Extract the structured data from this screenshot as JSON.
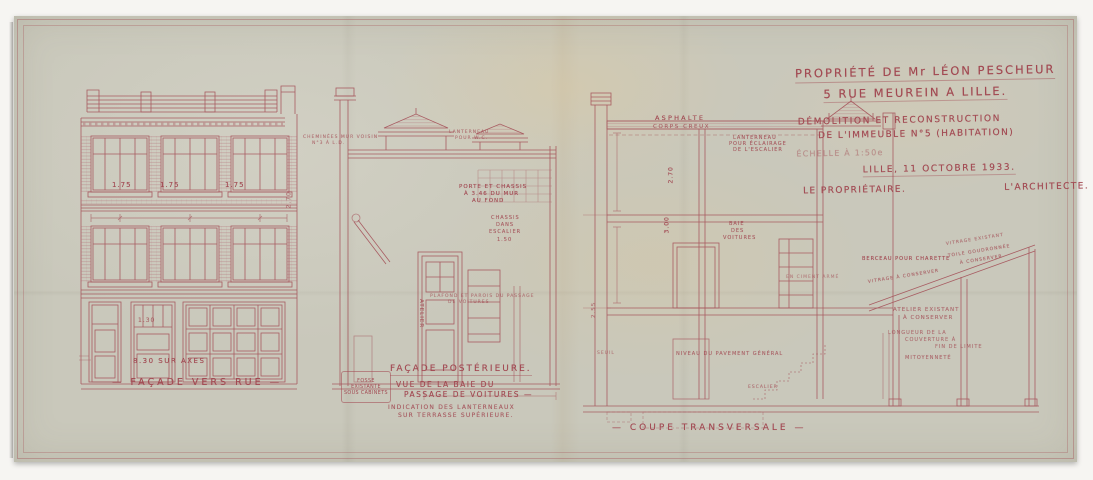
{
  "colors": {
    "ink": "#a24952",
    "hatch": "#b06a72",
    "paper": "#c9c8bb"
  },
  "title_block": {
    "line1": "PROPRIÉTÉ DE Mr LÉON PESCHEUR",
    "line2": "5 RUE MEUREIN A LILLE.",
    "line3": "DÉMOLITION ET RECONSTRUCTION",
    "line4": "DE L'IMMEUBLE N°5 (HABITATION)",
    "scale": "ÉCHELLE À 1:50e",
    "date": "LILLE, 11 OCTOBRE 1933.",
    "owner": "LE PROPRIÉTAIRE.",
    "architect": "L'ARCHITECTE."
  },
  "drawings": {
    "facade_rue": {
      "label": "— FAÇADE VERS RUE —"
    },
    "facade_post": {
      "title": "FAÇADE POSTÉRIEURE.",
      "sub1": "VUE DE LA BAIE DU",
      "sub2": "PASSAGE DE VOITURES —",
      "note1": "INDICATION DES LANTERNEAUX",
      "note2": "SUR TERRASSE SUPÉRIEURE.",
      "fosse": {
        "line1": "FOSSE",
        "line2": "EXISTANTE",
        "line3": "SOUS CABINETS"
      }
    },
    "coupe": {
      "label": "— COUPE TRANSVERSALE —"
    }
  },
  "annotations": [
    {
      "text": "1.75",
      "x": 112,
      "y": 181,
      "fs": 7
    },
    {
      "text": "1.75",
      "x": 160,
      "y": 181,
      "fs": 7
    },
    {
      "text": "1.75",
      "x": 225,
      "y": 181,
      "fs": 7
    },
    {
      "text": "2.70",
      "x": 289,
      "y": 205,
      "fs": 6,
      "rot": -90,
      "op": 0.7
    },
    {
      "text": "1.30",
      "x": 138,
      "y": 317,
      "fs": 6,
      "op": 0.8
    },
    {
      "text": "8.30 SUR AXES",
      "x": 133,
      "y": 357,
      "fs": 7,
      "ls": 1.5
    },
    {
      "text": "CHEMINÉES MUR VOISIN",
      "x": 303,
      "y": 135,
      "fs": 4.5,
      "op": 0.7
    },
    {
      "text": "N°3 À L.D.",
      "x": 312,
      "y": 141,
      "fs": 4.5,
      "op": 0.7
    },
    {
      "text": "LANTERNEAU",
      "x": 449,
      "y": 130,
      "fs": 4.5,
      "op": 0.7
    },
    {
      "text": "POUR W.C.",
      "x": 455,
      "y": 136,
      "fs": 4.5,
      "op": 0.7
    },
    {
      "text": "PORTE ET CHASSIS",
      "x": 459,
      "y": 184,
      "fs": 5.5
    },
    {
      "text": "À 3.46 DU MUR",
      "x": 464,
      "y": 191,
      "fs": 5.5
    },
    {
      "text": "AU FOND",
      "x": 472,
      "y": 198,
      "fs": 5.5
    },
    {
      "text": "CHASSIS",
      "x": 491,
      "y": 215,
      "fs": 5,
      "op": 0.85
    },
    {
      "text": "DANS",
      "x": 496,
      "y": 222,
      "fs": 5,
      "op": 0.85
    },
    {
      "text": "ESCALIER",
      "x": 489,
      "y": 229,
      "fs": 5,
      "op": 0.85
    },
    {
      "text": "1.50",
      "x": 497,
      "y": 237,
      "fs": 5,
      "op": 0.85
    },
    {
      "text": "ATELIER",
      "x": 421,
      "y": 296,
      "fs": 5.5,
      "rot": 90,
      "op": 0.8
    },
    {
      "text": "PLAFOND ET PAROIS DU PASSAGE",
      "x": 430,
      "y": 294,
      "fs": 4.5,
      "op": 0.65
    },
    {
      "text": "DE VOITURES",
      "x": 448,
      "y": 300,
      "fs": 4.5,
      "op": 0.65
    },
    {
      "text": "ASPHALTE",
      "x": 655,
      "y": 114,
      "fs": 6.5,
      "ls": 2.2
    },
    {
      "text": "CORPS CREUX",
      "x": 653,
      "y": 124,
      "fs": 5.5,
      "ls": 1.6,
      "op": 0.8
    },
    {
      "text": "LANTERNEAU",
      "x": 733,
      "y": 135,
      "fs": 5,
      "op": 0.85
    },
    {
      "text": "POUR ÉCLAIRAGE",
      "x": 729,
      "y": 141,
      "fs": 5,
      "op": 0.85
    },
    {
      "text": "DE L'ESCALIER",
      "x": 733,
      "y": 147,
      "fs": 5,
      "op": 0.85
    },
    {
      "text": "2.70",
      "x": 671,
      "y": 180,
      "fs": 6,
      "rot": -90
    },
    {
      "text": "3.00",
      "x": 667,
      "y": 230,
      "fs": 6,
      "rot": -90
    },
    {
      "text": "2.55",
      "x": 594,
      "y": 315,
      "fs": 5.5,
      "rot": -90,
      "op": 0.7
    },
    {
      "text": "BAIE",
      "x": 729,
      "y": 221,
      "fs": 5,
      "op": 0.85
    },
    {
      "text": "DES",
      "x": 731,
      "y": 228,
      "fs": 5,
      "op": 0.85
    },
    {
      "text": "VOITURES",
      "x": 723,
      "y": 235,
      "fs": 5,
      "op": 0.85
    },
    {
      "text": "EN CIMENT ARMÉ",
      "x": 786,
      "y": 275,
      "fs": 4.5,
      "op": 0.55
    },
    {
      "text": "BERCEAU POUR CHARETTE",
      "x": 862,
      "y": 256,
      "fs": 5
    },
    {
      "text": "VITRAGE EXISTANT",
      "x": 946,
      "y": 242,
      "fs": 4.5,
      "rot": -9,
      "op": 0.7
    },
    {
      "text": "TOILE GOUDRONNÉE",
      "x": 948,
      "y": 254,
      "fs": 4.5,
      "rot": -9,
      "op": 0.8
    },
    {
      "text": "À CONSERVER",
      "x": 960,
      "y": 261,
      "fs": 4.5,
      "rot": -9,
      "op": 0.8
    },
    {
      "text": "VITRAGE À CONSERVER",
      "x": 868,
      "y": 280,
      "fs": 4.5,
      "rot": -9,
      "op": 0.8
    },
    {
      "text": "ATELIER EXISTANT",
      "x": 893,
      "y": 307,
      "fs": 5.5,
      "op": 0.75
    },
    {
      "text": "À CONSERVER",
      "x": 903,
      "y": 315,
      "fs": 5.5,
      "op": 0.75
    },
    {
      "text": "LONGUEUR DE LA",
      "x": 888,
      "y": 330,
      "fs": 5,
      "op": 0.7
    },
    {
      "text": "COUVERTURE À",
      "x": 905,
      "y": 337,
      "fs": 5,
      "op": 0.7
    },
    {
      "text": "FIN DE LIMITE",
      "x": 935,
      "y": 344,
      "fs": 5,
      "op": 0.7
    },
    {
      "text": "MITOYENNETÉ",
      "x": 905,
      "y": 355,
      "fs": 5,
      "op": 0.75
    },
    {
      "text": "NIVEAU DU PAVEMENT GÉNÉRAL",
      "x": 676,
      "y": 351,
      "fs": 5,
      "op": 0.8
    },
    {
      "text": "SEUIL",
      "x": 597,
      "y": 351,
      "fs": 4.5,
      "op": 0.6
    },
    {
      "text": "ESCALIER",
      "x": 748,
      "y": 385,
      "fs": 4.5,
      "op": 0.7
    }
  ]
}
